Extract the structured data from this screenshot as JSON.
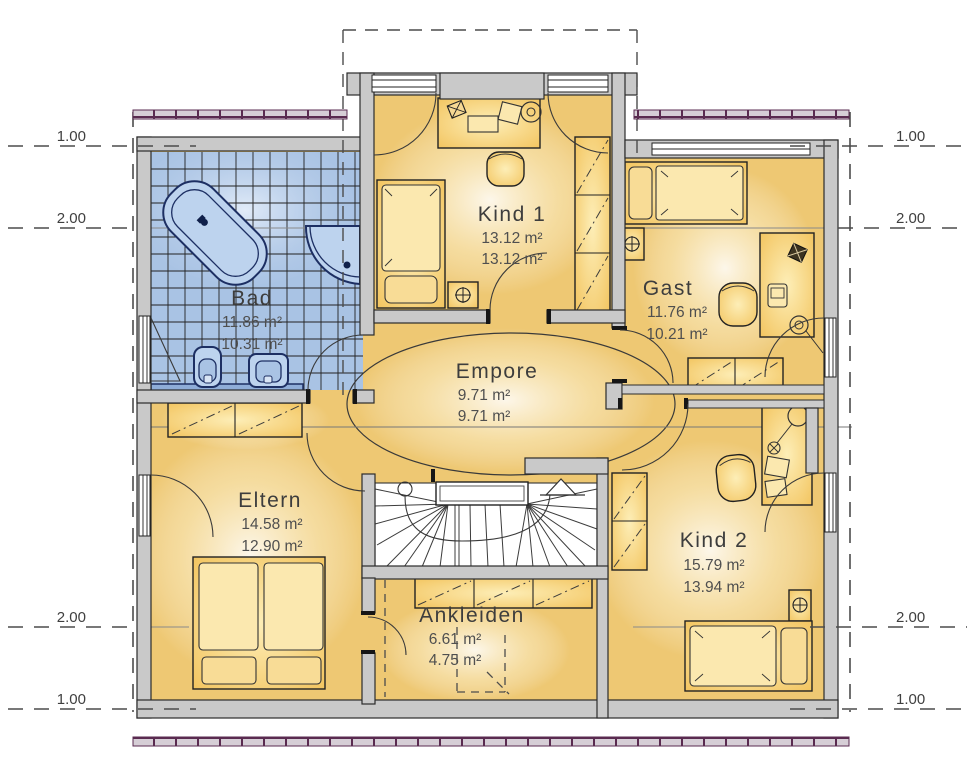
{
  "floor_plan": {
    "rooms": {
      "bad": {
        "name": "Bad",
        "area_line1": "11.86 m²",
        "area_line2": "10.31 m²"
      },
      "kind1": {
        "name": "Kind 1",
        "area_line1": "13.12 m²",
        "area_line2": "13.12 m²"
      },
      "gast": {
        "name": "Gast",
        "area_line1": "11.76 m²",
        "area_line2": "10.21 m²"
      },
      "empore": {
        "name": "Empore",
        "area_line1": "9.71 m²",
        "area_line2": "9.71 m²"
      },
      "eltern": {
        "name": "Eltern",
        "area_line1": "14.58 m²",
        "area_line2": "12.90 m²"
      },
      "kind2": {
        "name": "Kind 2",
        "area_line1": "15.79 m²",
        "area_line2": "13.94 m²"
      },
      "ankleiden": {
        "name": "Ankleiden",
        "area_line1": "6.61 m²",
        "area_line2": "4.75 m²"
      }
    },
    "dimension_labels": {
      "one_meter": "1.00",
      "two_meter": "2.00"
    },
    "colors": {
      "wall": "#c9c9c9",
      "floor": "#eec873",
      "tile": "#a9c3e4",
      "fixture": "#bdd3ee",
      "fixture_outline": "#1d2f63",
      "furniture": "#f2c25a",
      "roof_edge_border": "#5a2b50",
      "dash_line": "#4c4c4c"
    }
  }
}
